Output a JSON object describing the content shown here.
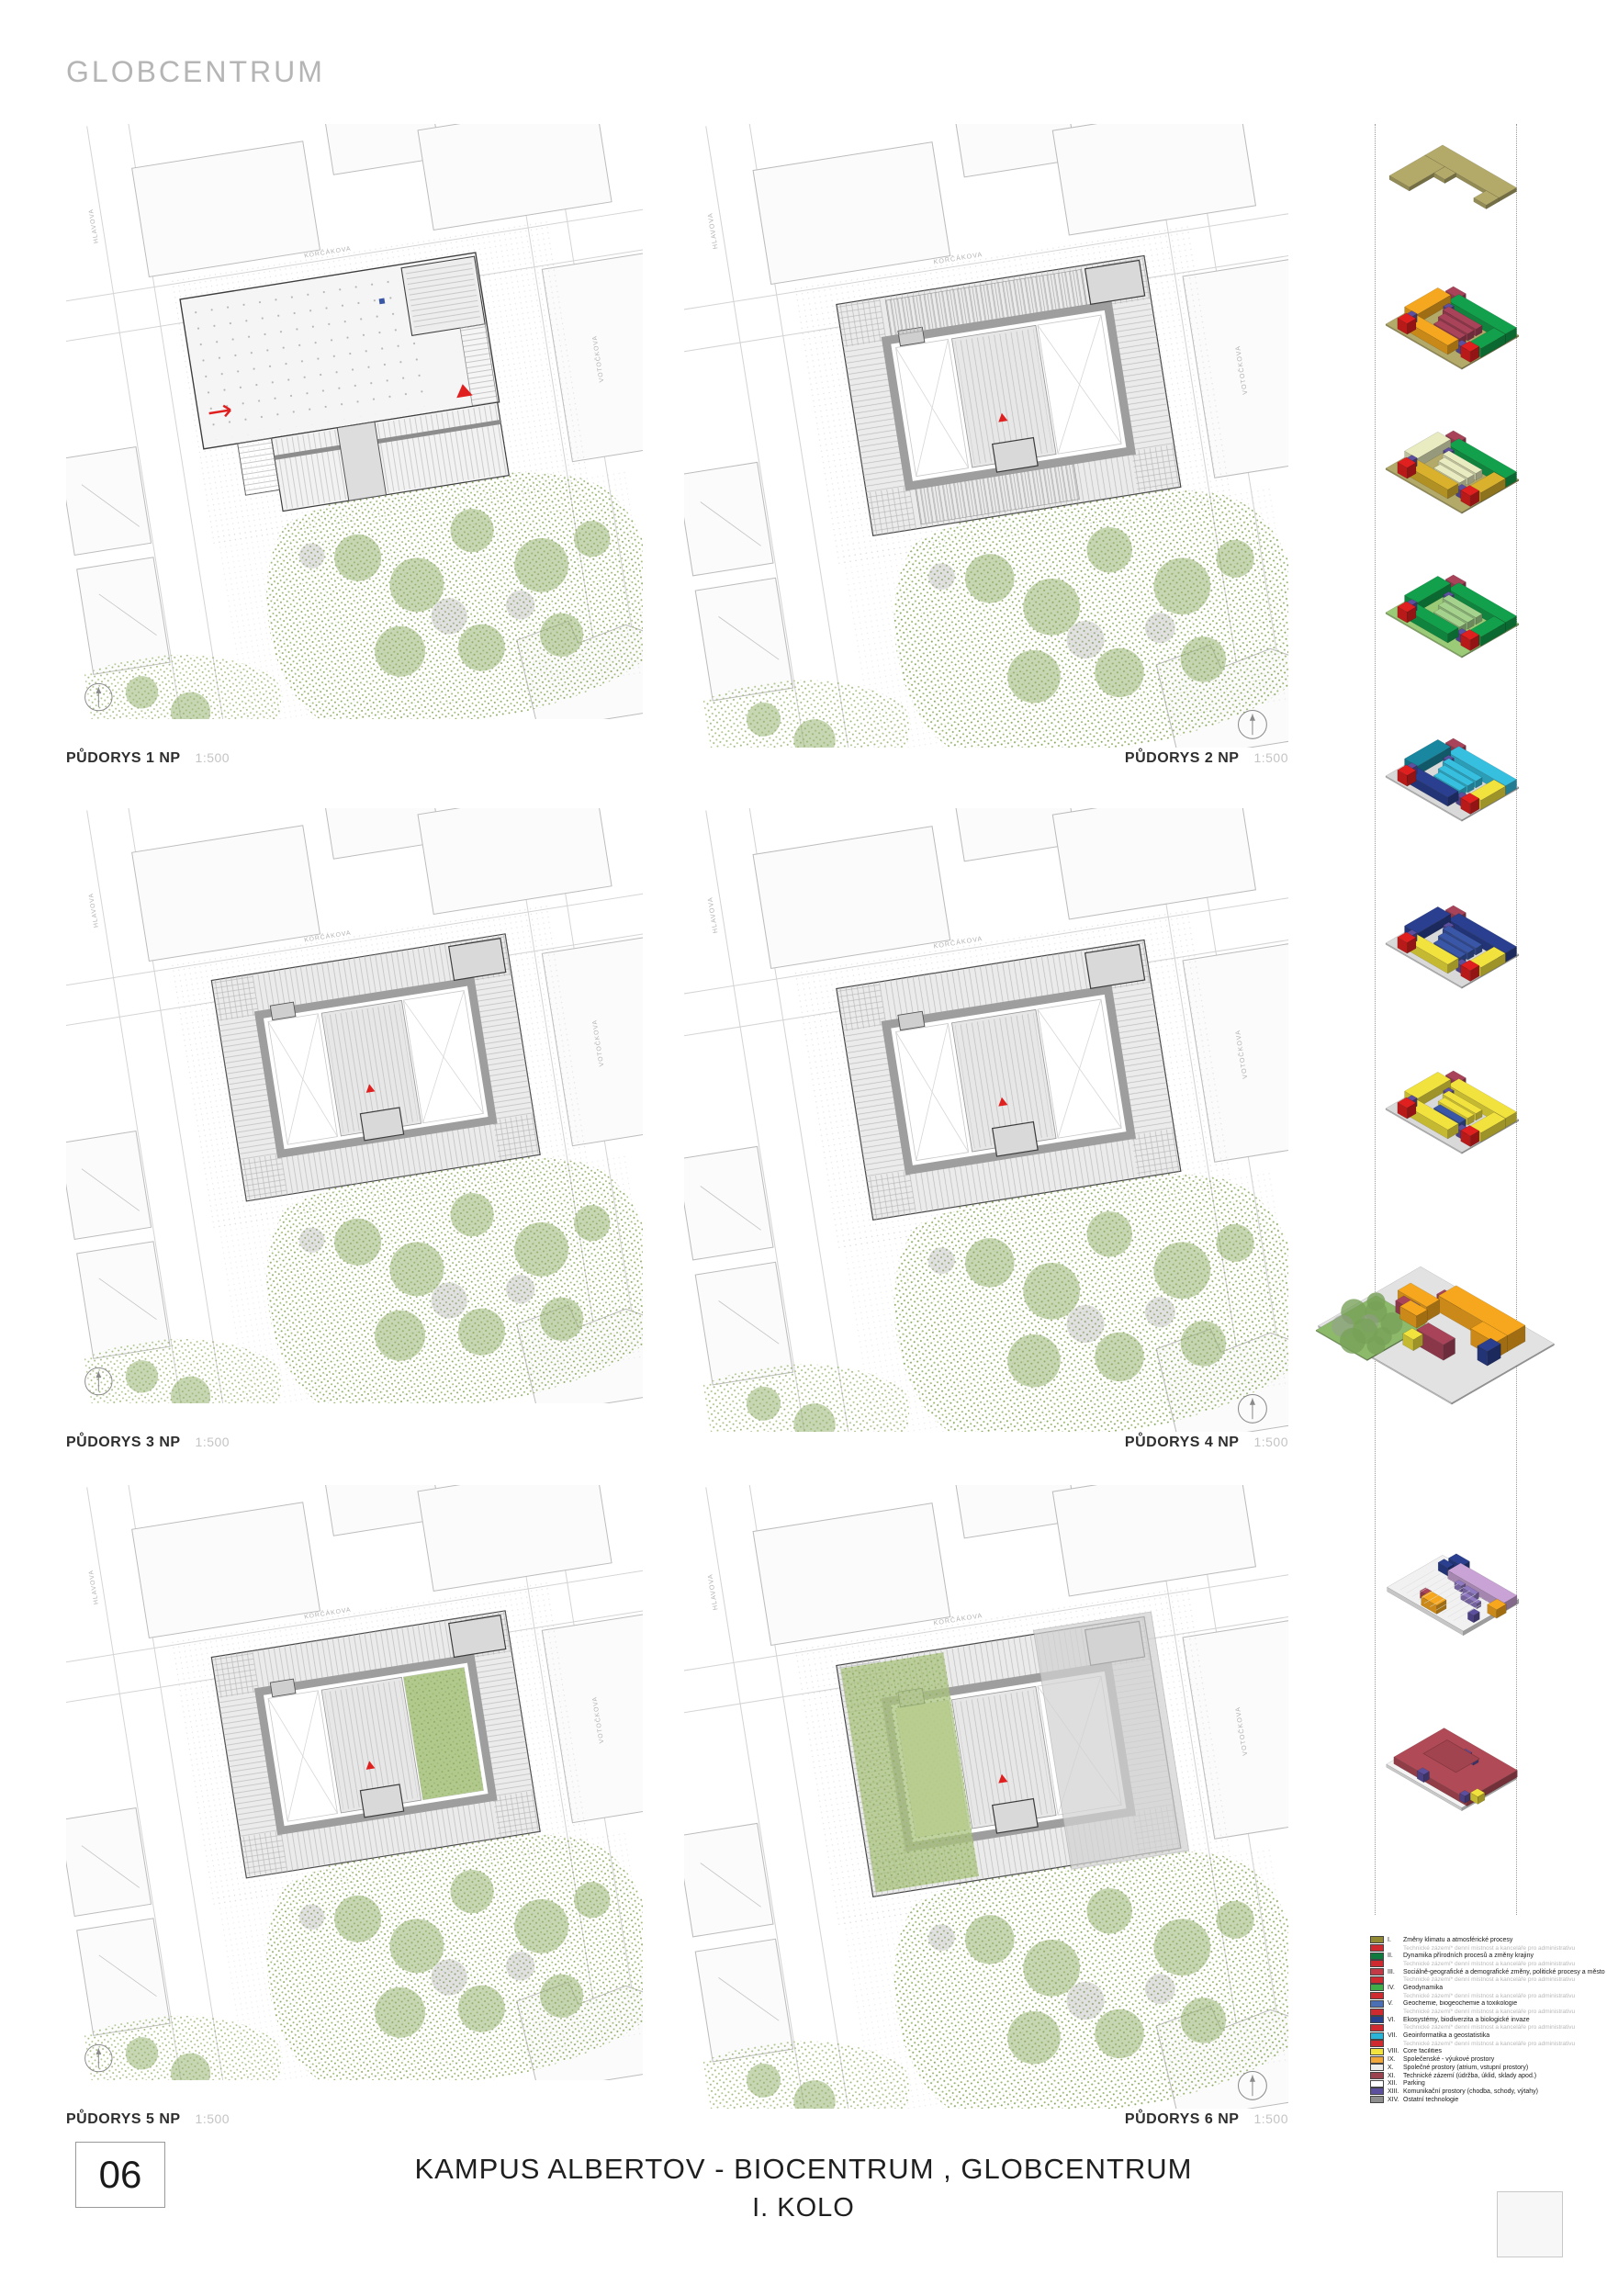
{
  "page": {
    "title": "GLOBCENTRUM",
    "number": "06",
    "footer_title": "KAMPUS ALBERTOV - BIOCENTRUM , GLOBCENTRUM",
    "footer_subtitle": "I. KOLO"
  },
  "plans": [
    {
      "label": "PŮDORYS 1 NP",
      "scale": "1:500",
      "variant": "slab"
    },
    {
      "label": "PŮDORYS 2 NP",
      "scale": "1:500",
      "variant": "ring-parking"
    },
    {
      "label": "PŮDORYS 3 NP",
      "scale": "1:500",
      "variant": "ring"
    },
    {
      "label": "PŮDORYS 4 NP",
      "scale": "1:500",
      "variant": "ring"
    },
    {
      "label": "PŮDORYS 5 NP",
      "scale": "1:500",
      "variant": "ring-green-right"
    },
    {
      "label": "PŮDORYS 6 NP",
      "scale": "1:500",
      "variant": "ring-green-left"
    }
  ],
  "streets": {
    "top": "KORČÁKOVA",
    "left": "HLAVOVA",
    "right": "VOTOČKOVA"
  },
  "accents": {
    "red": "#e01f1f",
    "maroon": "#a8435a",
    "purple": "#5c4f9e"
  },
  "axons": [
    {
      "type": "roof",
      "base": "#b3a968"
    },
    {
      "type": "ring",
      "base": "#b3a968",
      "top": "#13a04c",
      "left": "#f5a71f",
      "inner": "#a8435a",
      "bottom": "#f5a71f",
      "right": "#13a04c"
    },
    {
      "type": "ring",
      "base": "#b3a968",
      "top": "#13a04c",
      "left": "#e9ebc0",
      "inner": "#e9ebc0",
      "bottom": "#d9b12c",
      "right": "#d9b12c"
    },
    {
      "type": "ring",
      "base": "#9ccb77",
      "top": "#13a04c",
      "left": "#13a04c",
      "inner": "#a5d28d",
      "bottom": "#13a04c",
      "right": "#13a04c"
    },
    {
      "type": "ring",
      "base": "#d9d9d9",
      "top": "#36bfdf",
      "left": "#1a87a0",
      "inner": "#36bfdf",
      "bottom": "#2a3f8f",
      "right": "#f2e23d"
    },
    {
      "type": "ring",
      "base": "#d9d9d9",
      "top": "#2a3f8f",
      "left": "#2a3f8f",
      "inner": "#3a57a7",
      "bottom": "#f2e23d",
      "right": "#f2e23d"
    },
    {
      "type": "ring",
      "base": "#d9d9d9",
      "top": "#f2e23d",
      "left": "#f2e23d",
      "inner": "#f2e23d",
      "inner2": "#3a57a7",
      "bottom": "#f2e23d",
      "right": "#f2e23d"
    },
    {
      "type": "site",
      "ground": "#e2e2e2",
      "grass": "#8cb96a",
      "tree": "#78a159",
      "orange": "#f6a71d",
      "yellow": "#f2e23d",
      "navy": "#2a3f8f"
    },
    {
      "type": "pp1",
      "slab": "#f1f1f1",
      "lav": "#c9a3d6",
      "violet": "#8f79c0",
      "orange": "#f6a71d",
      "navy": "#2a3f8f"
    },
    {
      "type": "pp2",
      "slab": "#f4f4f4",
      "plate": "#b04a56",
      "yellow": "#f2e23d"
    }
  ],
  "legend": {
    "items": [
      {
        "numeral": "I.",
        "label": "Změny klimatu a atmosférické procesy",
        "color": "#918a33",
        "sub": false
      },
      {
        "numeral": "",
        "label": "Technické zázemí* denní místnost a kanceláře pro administrativu",
        "color": "#cf2a30",
        "sub": true
      },
      {
        "numeral": "II.",
        "label": "Dynamika přírodních procesů a změny krajiny",
        "color": "#0f7a3e",
        "sub": false
      },
      {
        "numeral": "",
        "label": "Technické zázemí* denní místnost a kanceláře pro administrativu",
        "color": "#cf2a30",
        "sub": true
      },
      {
        "numeral": "III.",
        "label": "Sociálně-geografické a demografické změny, politické procesy a město",
        "color": "#c23a46",
        "sub": false
      },
      {
        "numeral": "",
        "label": "Technické zázemí* denní místnost a kanceláře pro administrativu",
        "color": "#cf2a30",
        "sub": true
      },
      {
        "numeral": "IV.",
        "label": "Geodynamika",
        "color": "#3fae49",
        "sub": false
      },
      {
        "numeral": "",
        "label": "Technické zázemí* denní místnost a kanceláře pro administrativu",
        "color": "#cf2a30",
        "sub": true
      },
      {
        "numeral": "V.",
        "label": "Geochemie, biogeochemie a toxikologie",
        "color": "#4a6fb5",
        "sub": false
      },
      {
        "numeral": "",
        "label": "Technické zázemí* denní místnost a kanceláře pro administrativu",
        "color": "#cf2a30",
        "sub": true
      },
      {
        "numeral": "VI.",
        "label": "Ekosystémy, biodiverzita a biologické invaze",
        "color": "#27408b",
        "sub": false
      },
      {
        "numeral": "",
        "label": "Technické zázemí* denní místnost a kanceláře pro administrativu",
        "color": "#cf2a30",
        "sub": true
      },
      {
        "numeral": "VII.",
        "label": "Geoinformatika a geostatistika",
        "color": "#2ab5d8",
        "sub": false
      },
      {
        "numeral": "",
        "label": "Technické zázemí* denní místnost a kanceláře pro administrativu",
        "color": "#cf2a30",
        "sub": true
      },
      {
        "numeral": "VIII.",
        "label": "Core facilities",
        "color": "#f2e23d",
        "sub": false
      },
      {
        "numeral": "IX.",
        "label": "Společenské - výukové prostory",
        "color": "#f0a63a",
        "sub": false
      },
      {
        "numeral": "X.",
        "label": "Společné prostory (atrium, vstupní prostory)",
        "color": "#ededed",
        "sub": false
      },
      {
        "numeral": "XI.",
        "label": "Technické zázemí (údržba, úklid, sklady apod.)",
        "color": "#9c4350",
        "sub": false
      },
      {
        "numeral": "XII.",
        "label": "Parking",
        "color": "#ffffff",
        "sub": false
      },
      {
        "numeral": "XIII.",
        "label": "Komunikační prostory (chodba, schody, výtahy)",
        "color": "#5b4f9e",
        "sub": false
      },
      {
        "numeral": "XIV.",
        "label": "Ostatní technologie",
        "color": "#8e8e8e",
        "sub": false
      }
    ]
  }
}
